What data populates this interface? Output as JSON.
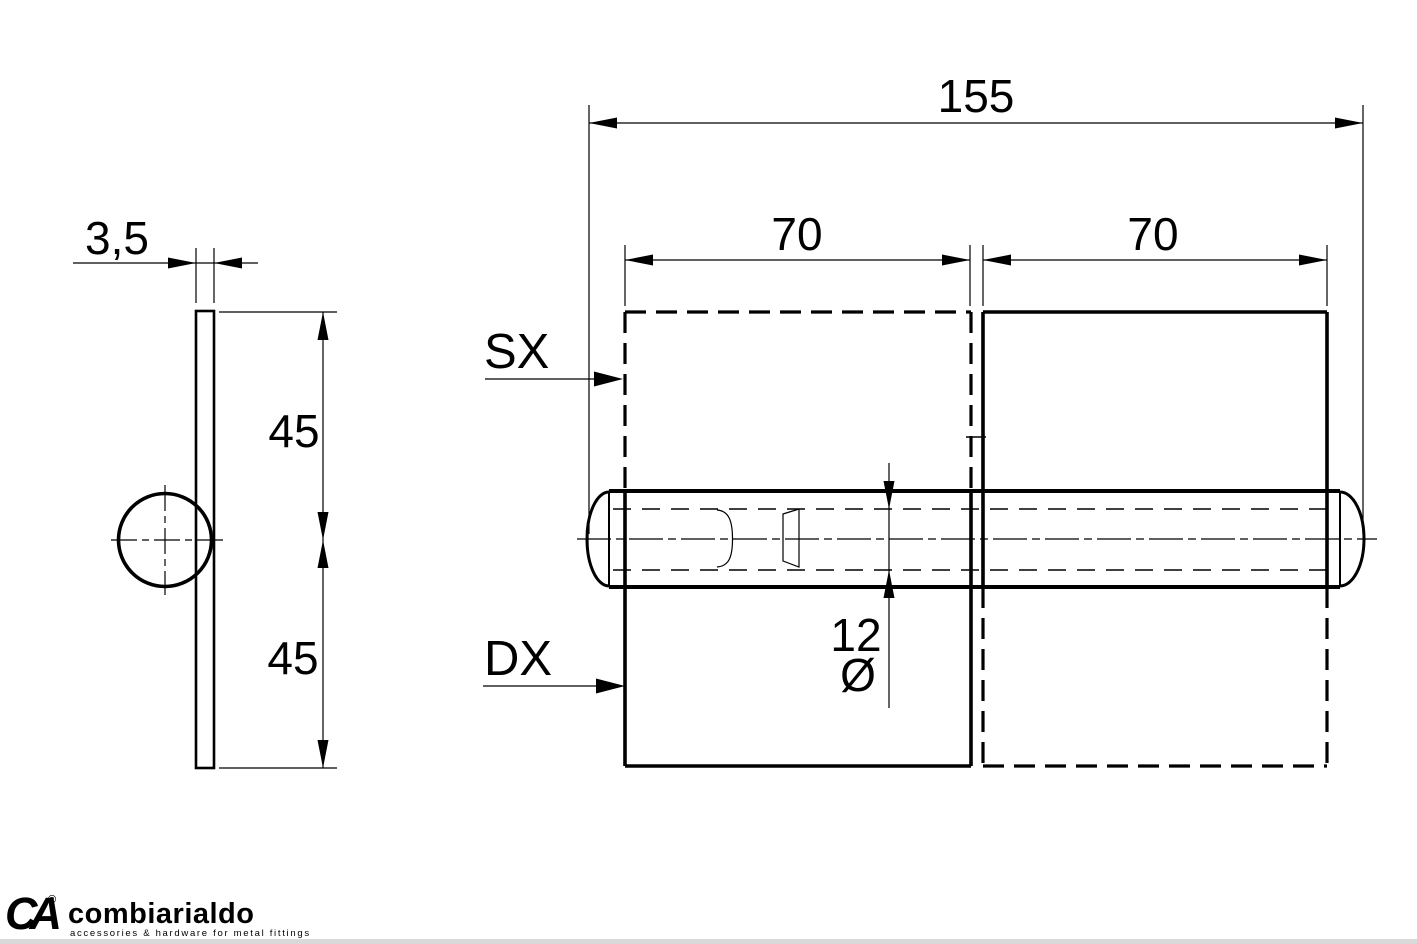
{
  "drawing": {
    "background": "#ffffff",
    "line_color": "#000000",
    "dimensions": {
      "total_length": "155",
      "left_leaf_width": "70",
      "right_leaf_width": "70",
      "upper_leaf_height": "45",
      "lower_leaf_height": "45",
      "plate_thickness": "3,5",
      "pin_diameter_value": "12",
      "diameter_symbol": "Ø"
    },
    "labels": {
      "left_hand": "SX",
      "right_hand": "DX"
    }
  },
  "logo": {
    "monogram": "CA",
    "registered_mark": "®",
    "brand_name": "combiarialdo",
    "tagline": "accessories & hardware for metal fittings",
    "brand_color": "#d22d2a",
    "name_color": "#2f2f31",
    "tagline_color": "#9b9b9b"
  }
}
